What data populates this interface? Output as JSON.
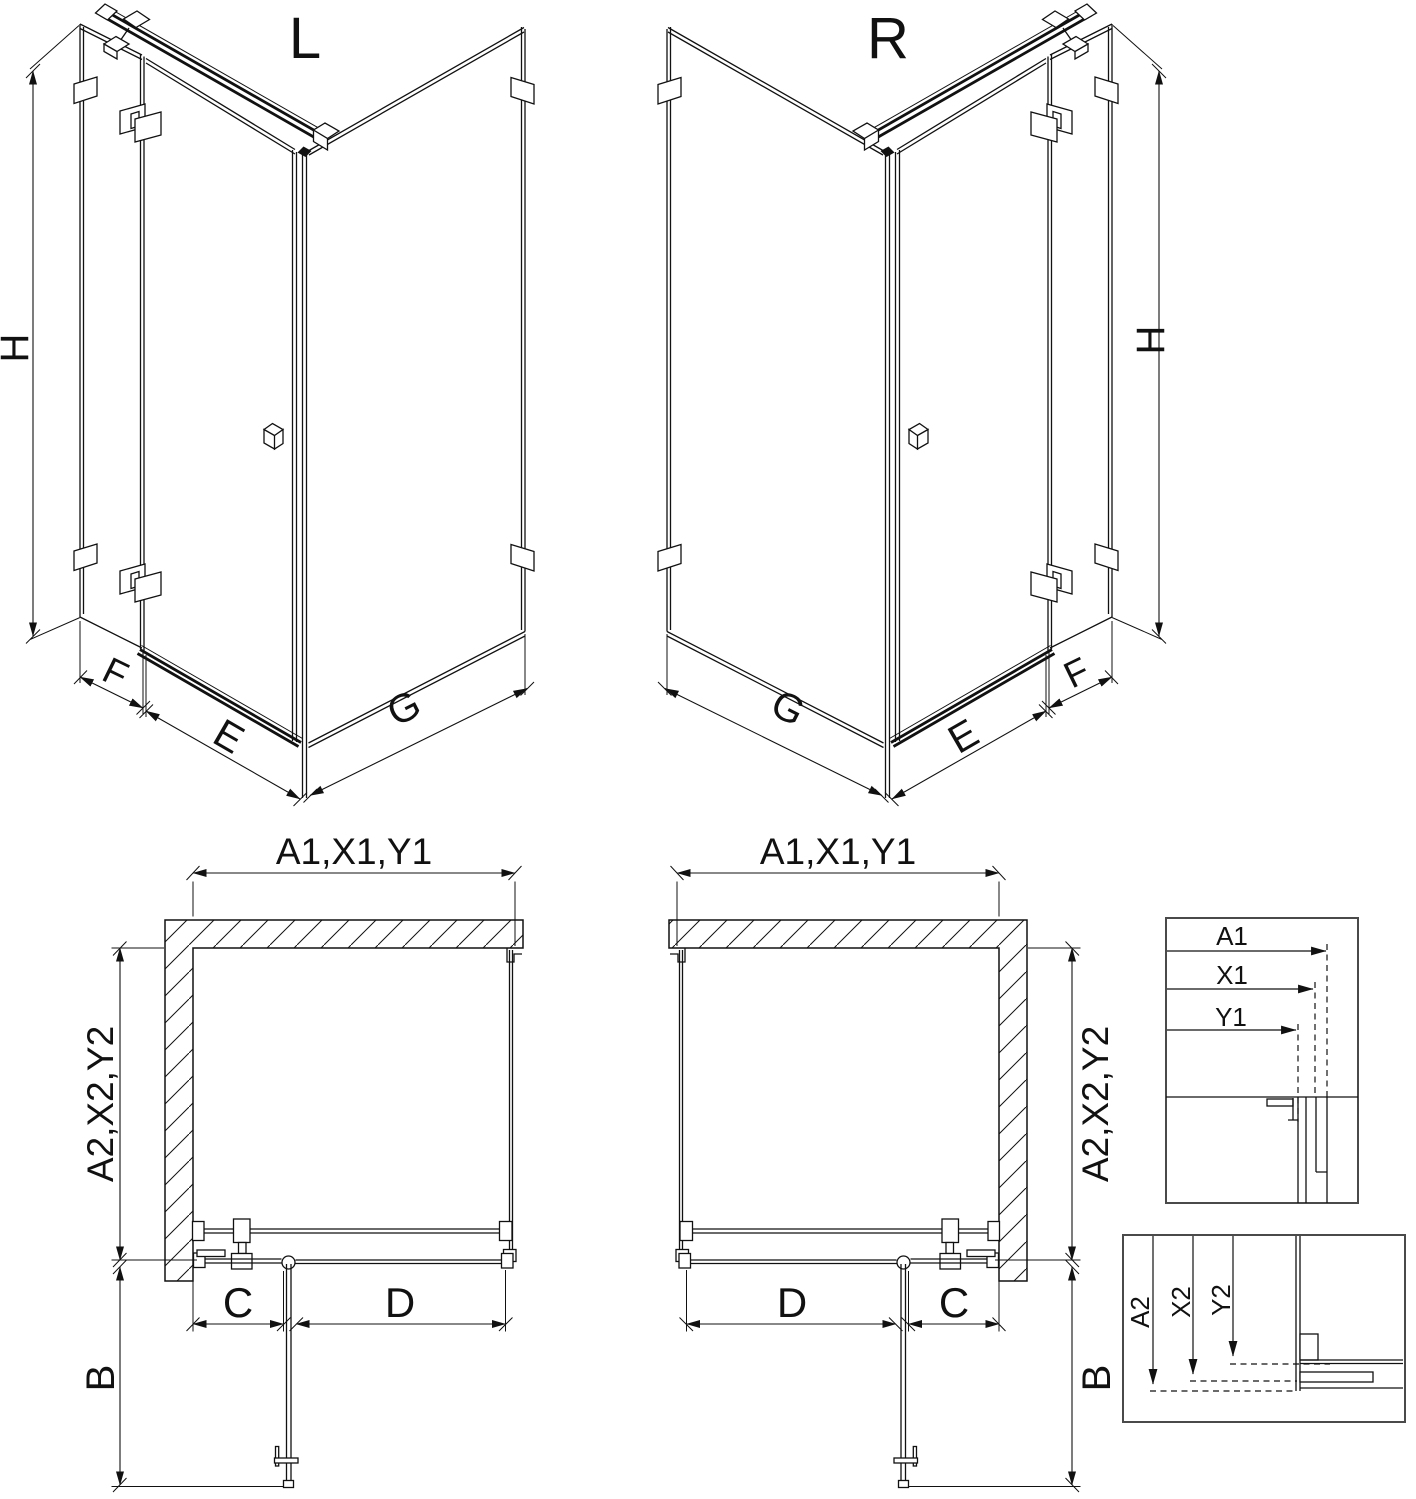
{
  "iso_left": {
    "title": "L",
    "height": "H",
    "side_panel": "F",
    "door": "E",
    "fixed_wall": "G"
  },
  "iso_right": {
    "title": "R",
    "height": "H",
    "side_panel": "F",
    "door": "E",
    "fixed_wall": "G"
  },
  "plan_left": {
    "width": "A1,X1,Y1",
    "depth": "A2,X2,Y2",
    "door_swing": "B",
    "fixed_segment": "C",
    "door_segment": "D"
  },
  "plan_right": {
    "width": "A1,X1,Y1",
    "depth": "A2,X2,Y2",
    "door_swing": "B",
    "fixed_segment": "C",
    "door_segment": "D"
  },
  "detail_width": {
    "labels": [
      "A1",
      "X1",
      "Y1"
    ]
  },
  "detail_depth": {
    "labels": [
      "A2",
      "X2",
      "Y2"
    ]
  },
  "colors": {
    "line": "#111111",
    "box_border": "#4a4a4a",
    "background": "#ffffff"
  }
}
